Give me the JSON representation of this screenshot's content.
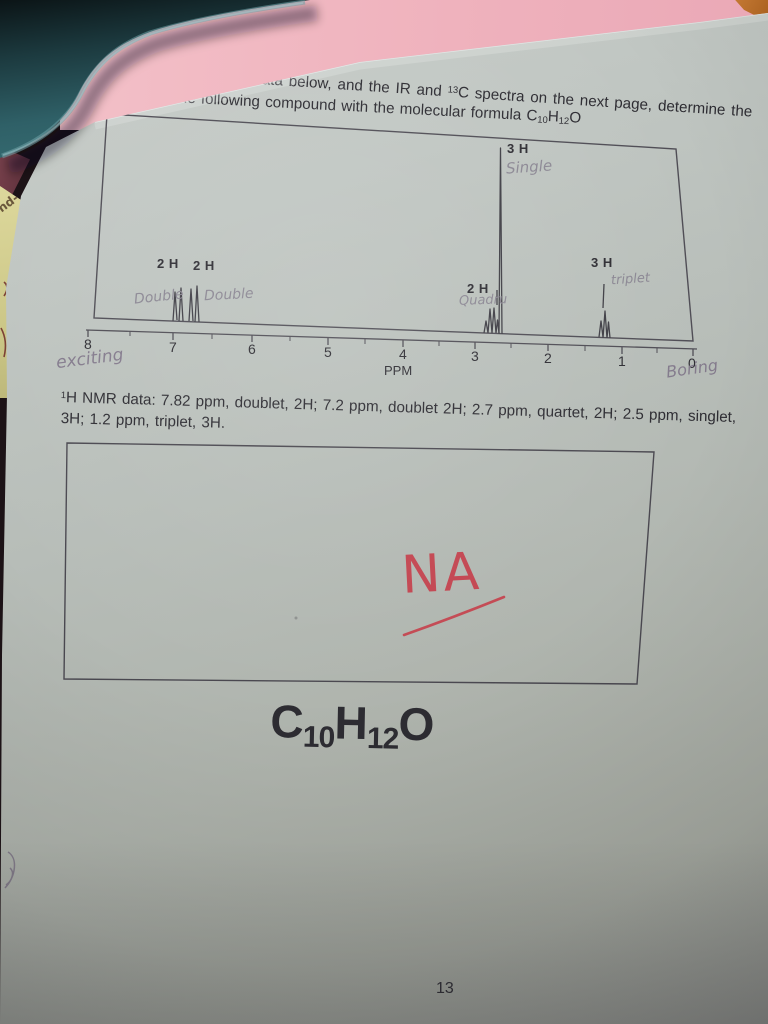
{
  "page": {
    "header": "(20 points) Spectroscopy",
    "instr1": {
      "pre": "(a) Using the ",
      "sup1": "1",
      "mid1": "H NMR data below, and the IR and ",
      "sup2": "13",
      "mid2": "C spectra on the next page, determine the"
    },
    "instr2": {
      "pre": "structure of the following compound with the molecular formula C",
      "sub1": "10",
      "mid": "H",
      "sub2": "12",
      "end": "O"
    },
    "nmr1": {
      "sup": "1",
      "text": "H NMR data: 7.82 ppm, doublet, 2H; 7.2 ppm, doublet 2H; 2.7 ppm, quartet, 2H; 2.5 ppm, singlet,"
    },
    "nmr2": "3H; 1.2 ppm, triplet, 3H.",
    "formula": {
      "c": "C",
      "c_sub": "10",
      "h": "H",
      "h_sub": "12",
      "o": "O"
    },
    "page_number": "13"
  },
  "chart": {
    "labels": {
      "doublet1": "2 H",
      "doublet2": "2 H",
      "quartet": "2 H",
      "singlet": "3 H",
      "triplet": "3 H"
    },
    "axis_ticks": [
      "8",
      "7",
      "6",
      "5",
      "4",
      "3",
      "2",
      "1",
      "0"
    ],
    "axis_label": "PPM"
  },
  "handwriting": {
    "single": "Single",
    "double1": "Double",
    "double2": "Double",
    "quartet": "Quadru",
    "triplet": "triplet",
    "exciting": "exciting",
    "boring": "Boring",
    "na": "NA",
    "side_note": "nd-"
  },
  "colors": {
    "paper": "#b7bdb8",
    "pink_background": "#efb2bd",
    "teal_binder": "#2f6067",
    "yellow_note": "#ddd89c",
    "red_pen": "#c53d49",
    "pencil": "#8b8793",
    "ink": "#2d2c32"
  },
  "chart_data": {
    "type": "line",
    "title": "1H NMR spectrum",
    "xlabel": "PPM",
    "x_ticks": [
      8,
      7,
      6,
      5,
      4,
      3,
      2,
      1,
      0
    ],
    "x_axis_reversed": true,
    "grid": false,
    "peaks": [
      {
        "ppm": 7.82,
        "multiplicity": "doublet",
        "integration": "2H"
      },
      {
        "ppm": 7.2,
        "multiplicity": "doublet",
        "integration": "2H"
      },
      {
        "ppm": 2.7,
        "multiplicity": "quartet",
        "integration": "2H"
      },
      {
        "ppm": 2.5,
        "multiplicity": "singlet",
        "integration": "3H"
      },
      {
        "ppm": 1.2,
        "multiplicity": "triplet",
        "integration": "3H"
      }
    ]
  }
}
